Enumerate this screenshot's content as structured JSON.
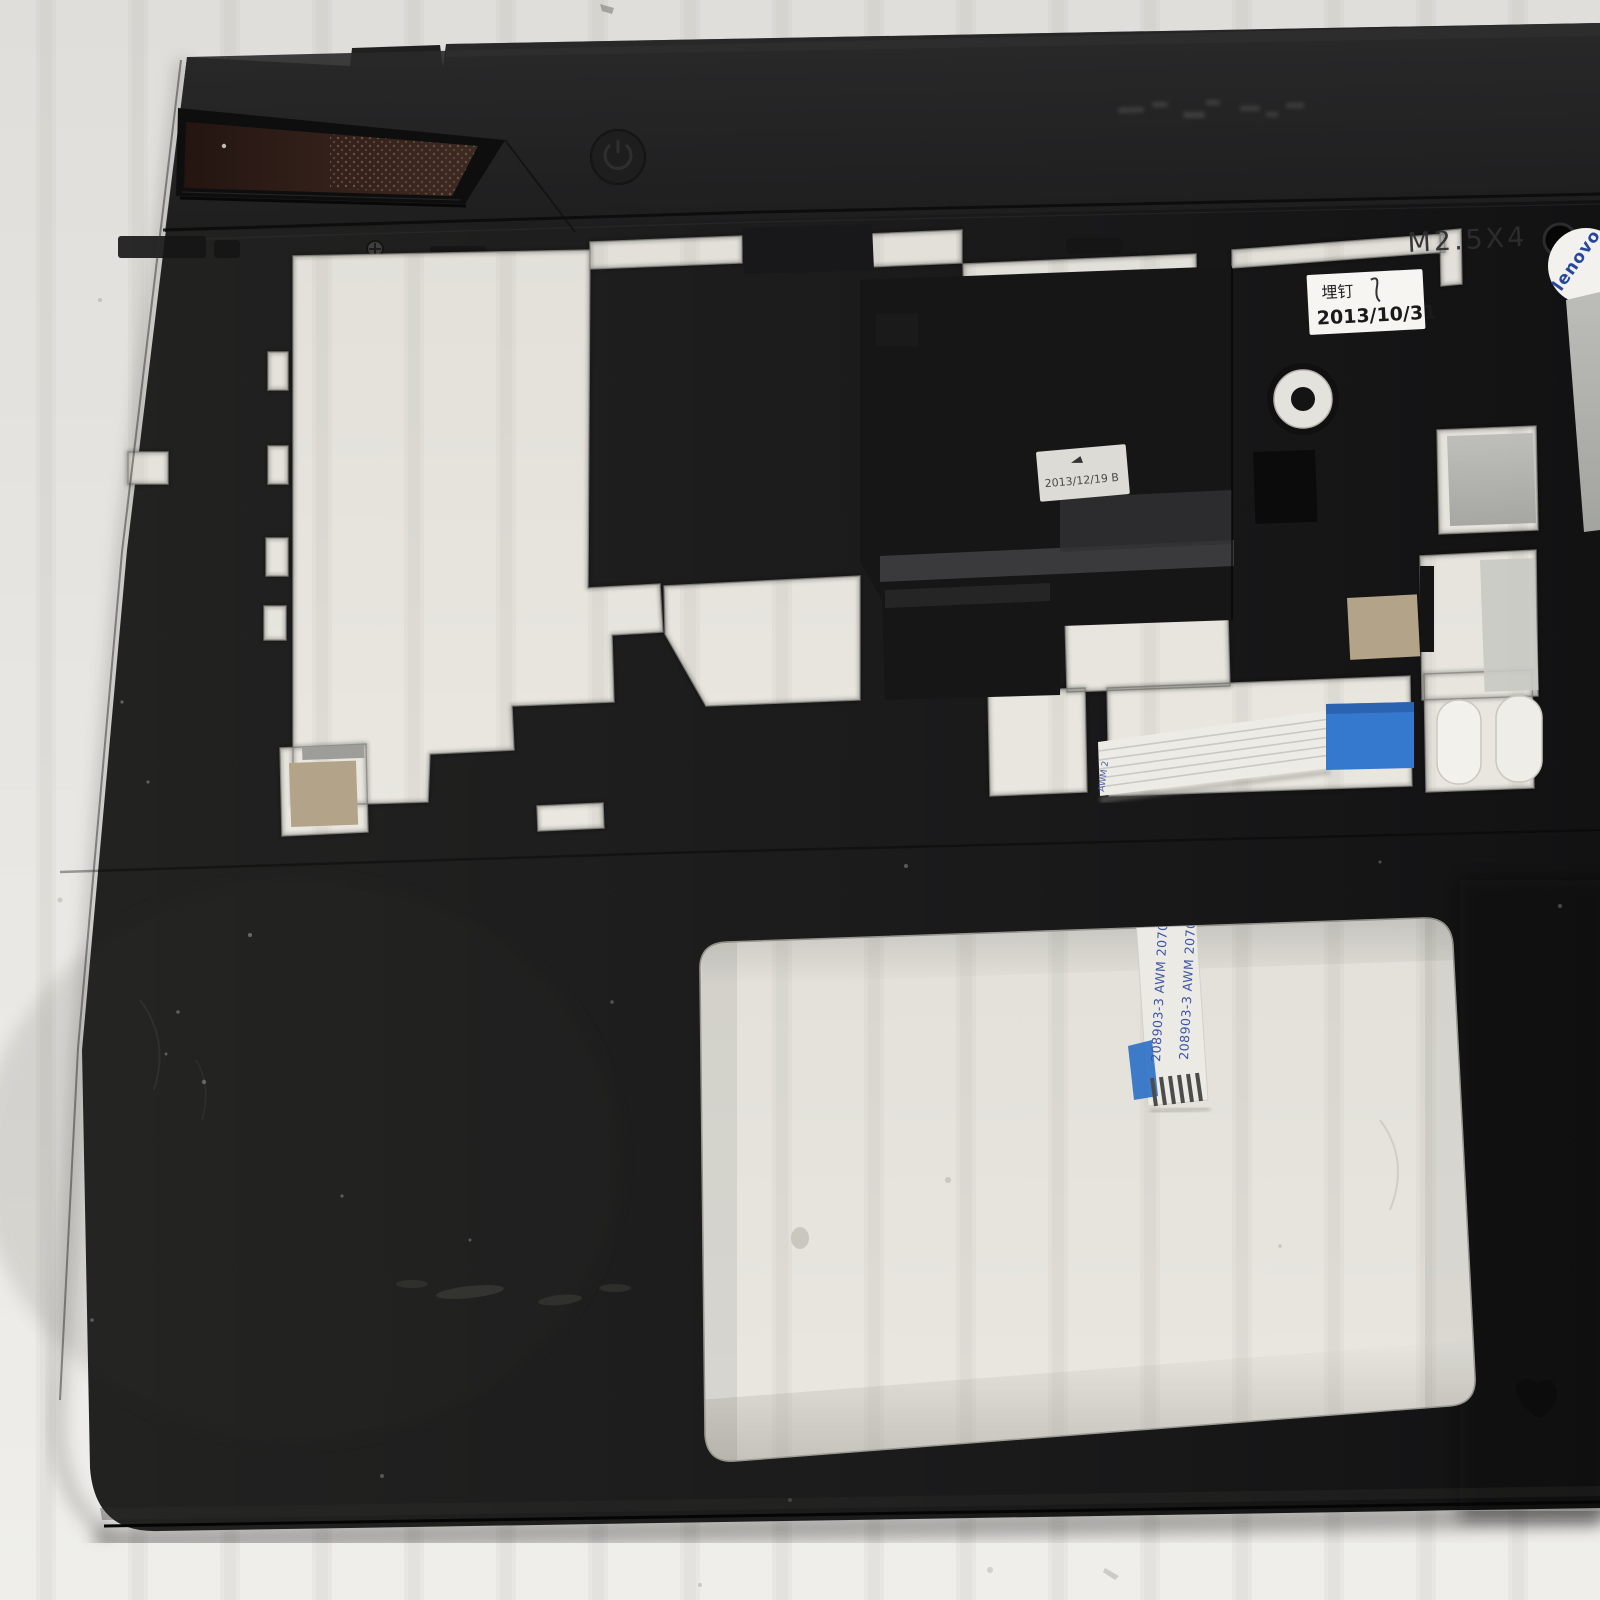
{
  "scene": {
    "subject": "black laptop palmrest top-cover part photographed on a light cardboard surface",
    "orientation": "part slightly rotated, keyboard cutout at top, touchpad cutout at bottom"
  },
  "labels": {
    "assembly_date_sticker": {
      "line1": "埋钉",
      "line2": "2013/10/31"
    },
    "inspection_sticker": {
      "text": "2013/12/19 B"
    },
    "embossed_screw_spec": {
      "text": "M2.5X4"
    },
    "brand_sticker": {
      "text": "lenovo"
    },
    "touchpad_cable_print": {
      "column1": "208903-3  AWM 20706 105C 6",
      "column2": "208903-3  AWM 20706 105C 6"
    },
    "keyboard_cable_print": {
      "text": "AWM 2"
    }
  },
  "colors": {
    "background": "#e8e6e2",
    "part_black": "#1d1d1e",
    "grille_maroon": "#33201a",
    "cable_blue": "#3579cf",
    "gold_pad": "#b3a489",
    "sticker_white": "#f6f5f1",
    "print_blue": "#3d55a5",
    "gray_pad": "#b4b5b1"
  }
}
